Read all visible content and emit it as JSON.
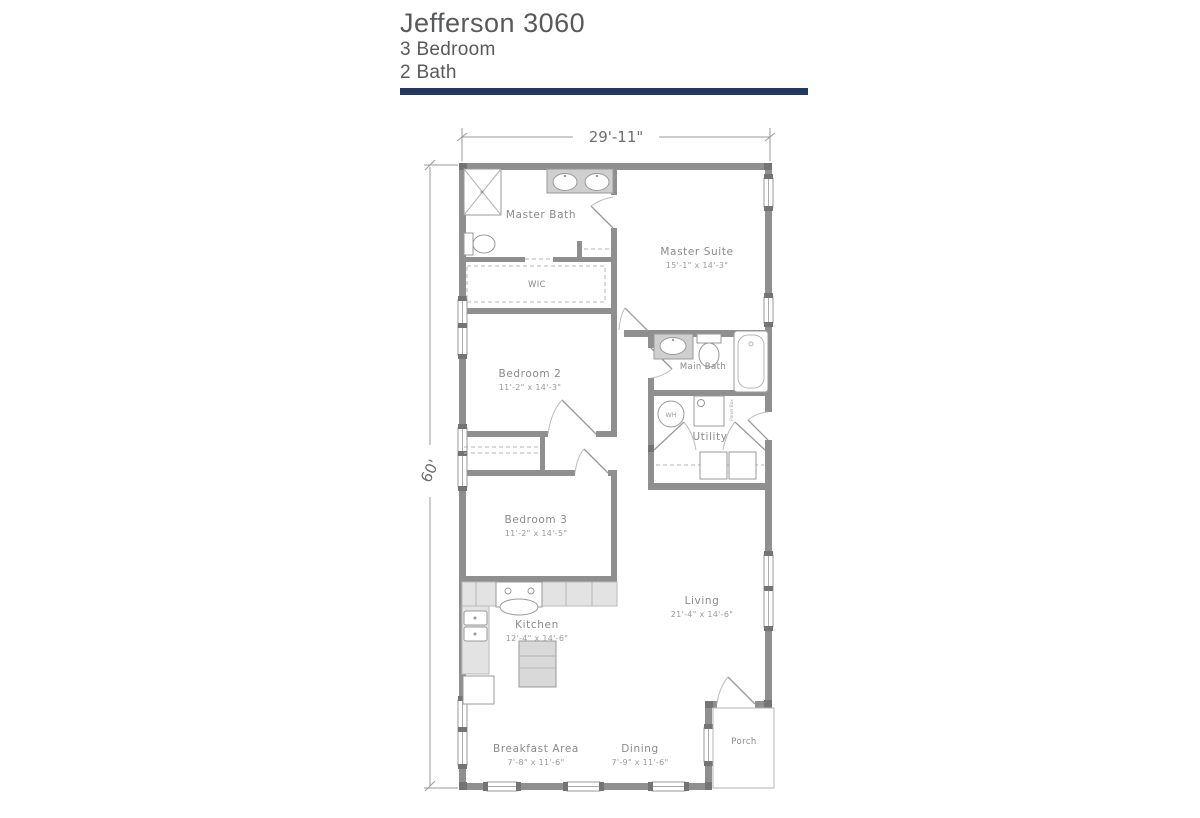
{
  "header": {
    "title": "Jefferson 3060",
    "bedrooms": "3 Bedroom",
    "baths": "2 Bath"
  },
  "dimensions": {
    "overall_width": "29'-11\"",
    "overall_depth": "60'"
  },
  "rooms": {
    "master_bath": {
      "name": "Master Bath"
    },
    "wic": {
      "name": "WIC"
    },
    "master_suite": {
      "name": "Master Suite",
      "size": "15'-1\" x 14'-3\""
    },
    "bedroom_2": {
      "name": "Bedroom 2",
      "size": "11'-2\" x 14'-3\""
    },
    "main_bath": {
      "name": "Main Bath"
    },
    "utility": {
      "name": "Utility"
    },
    "bedroom_3": {
      "name": "Bedroom 3",
      "size": "11'-2\" x 14'-5\""
    },
    "kitchen": {
      "name": "Kitchen",
      "size": "12'-4\" x 14'-6\""
    },
    "living": {
      "name": "Living",
      "size": "21'-4\" x 14'-6\""
    },
    "breakfast_area": {
      "name": "Breakfast Area",
      "size": "7'-8\" x 11'-6\""
    },
    "dining": {
      "name": "Dining",
      "size": "7'-9\" x 11'-6\""
    },
    "porch": {
      "name": "Porch"
    }
  },
  "fixtures": {
    "water_heater": "WH",
    "panel": "Panel Box"
  },
  "colors": {
    "accent_bar": "#1f3864",
    "wall": "#8f8f8f",
    "header_text": "#58595b"
  }
}
